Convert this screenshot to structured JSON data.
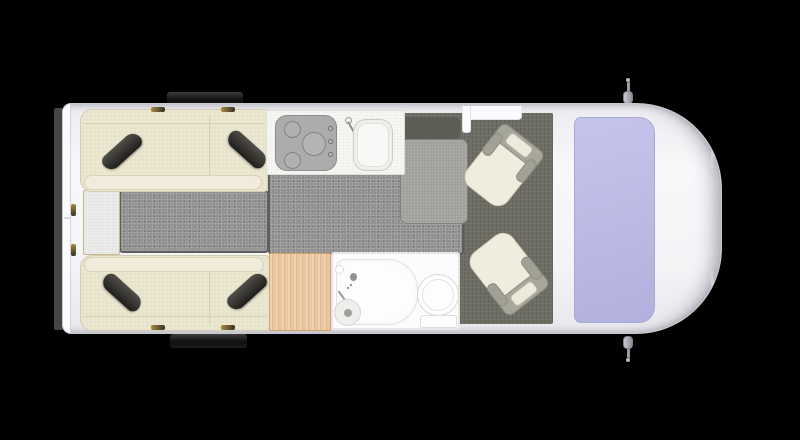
{
  "scene": {
    "type": "motorhome-floorplan-top-view",
    "background_color": "#000000"
  },
  "vehicle": {
    "front": "right",
    "rear": "left",
    "body_color": "#f4f4f7",
    "outline_color": "#c9c9cf",
    "windshield_color": "#b8b7e2",
    "side_window_color": "#1c1c1c",
    "mirror_count": 2,
    "rear_door_count": 2
  },
  "areas": {
    "rear_bedroom": {
      "beds": [
        {
          "id": "bed-top",
          "mattress_color": "#ebe6d0",
          "pillow_count": 2,
          "pillow_color": "#33312c"
        },
        {
          "id": "bed-bottom",
          "mattress_color": "#ebe6d0",
          "pillow_count": 2,
          "pillow_color": "#33312c"
        }
      ],
      "aisle_floor_color": "#8f8f8f",
      "rear_step_color": "#ededeb"
    },
    "kitchen": {
      "counter_color": "#f6f6f3",
      "cooktop_color": "#acacac",
      "burner_count": 3,
      "knob_count": 3,
      "sink_color": "#efefec",
      "floor_color": "#8f8f8f"
    },
    "wardrobe": {
      "wood_color": "#eac79e"
    },
    "bathroom": {
      "wall_color": "#fcfcfc",
      "fixtures": [
        "shower-tray",
        "shower-circle-drain",
        "washbasin-faucet",
        "toilet",
        "toilet-tank"
      ]
    },
    "entry": {
      "step_color": "#5d5d55",
      "rug_color": "#9f9f9b",
      "door_color": "#fbfbfd"
    },
    "cab": {
      "floor_color": "#6d6d64",
      "seat_count": 2,
      "seats": [
        {
          "id": "seat-top",
          "upholstery_color": "#efedde",
          "frame_color": "#a7a69b"
        },
        {
          "id": "seat-bottom",
          "upholstery_color": "#efedde",
          "frame_color": "#a7a69b"
        }
      ]
    }
  }
}
